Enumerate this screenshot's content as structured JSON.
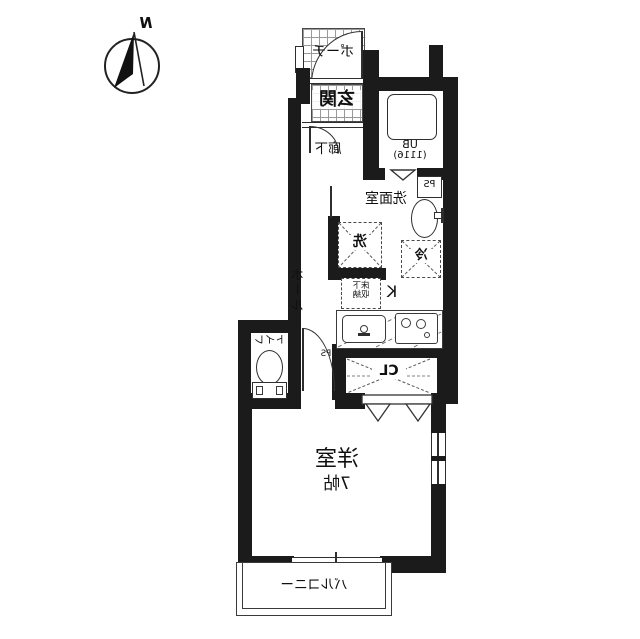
{
  "compass": {
    "north_label": "N"
  },
  "labels": {
    "porch": "ポーチ",
    "entrance": "玄関",
    "corridor": "廊下",
    "unit_bath_line1": "UB",
    "unit_bath_line2": "(1116)",
    "pipe_space_top": "PS",
    "washroom": "洗面室",
    "washing_machine": "洗",
    "refrigerator": "冷",
    "hall": "ホール",
    "kitchen": "K",
    "floor_storage_line1": "床下",
    "floor_storage_line2": "収納",
    "pipe_space_hall": "PS",
    "toilet": "トイレ",
    "closet": "CL",
    "main_room": "洋室",
    "main_room_size": "7帖",
    "balcony": "バルコニー"
  },
  "colors": {
    "wall": "#1b1b1b",
    "line": "#2e2e2e",
    "grid": "#9a9a9a",
    "bg": "#ffffff"
  }
}
